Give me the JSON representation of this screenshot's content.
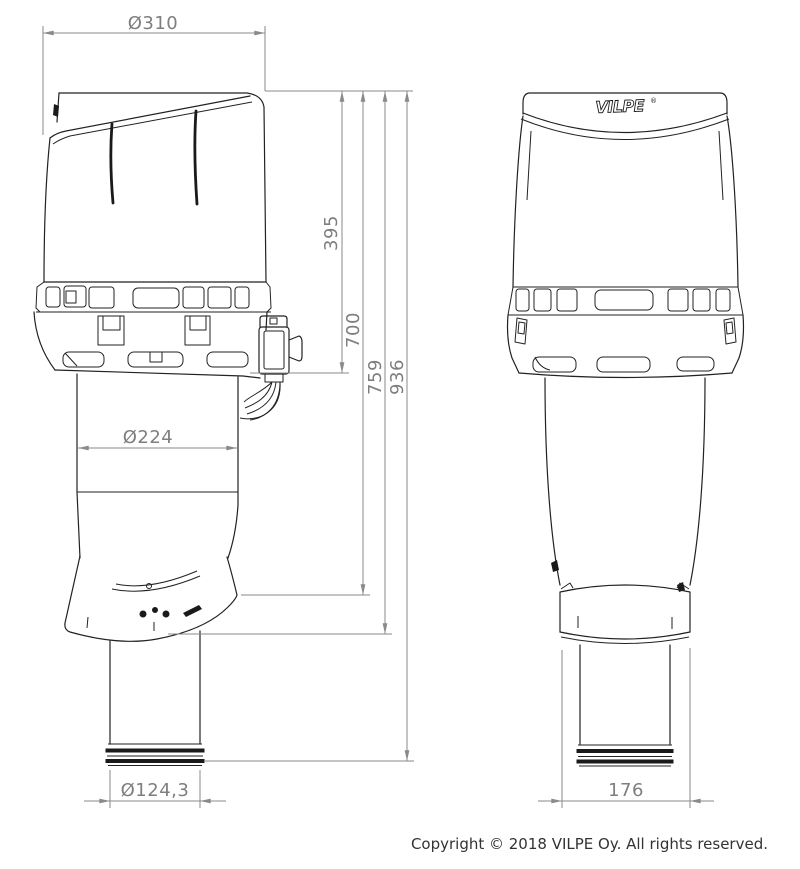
{
  "drawing": {
    "title": "VILPE roof fan dimensional drawing",
    "dimensions": {
      "hood_diameter": "Ø310",
      "hood_height": "395",
      "height_to_flashing_top": "700",
      "height_to_flashing_bottom": "759",
      "total_height": "936",
      "duct_diameter": "Ø224",
      "pipe_diameter": "Ø124,3",
      "flashing_width": "176"
    },
    "branding": {
      "logo_text": "VILPE",
      "registered_mark": "®"
    }
  },
  "footer": {
    "copyright": "Copyright © 2018 VILPE Oy. All rights reserved."
  }
}
